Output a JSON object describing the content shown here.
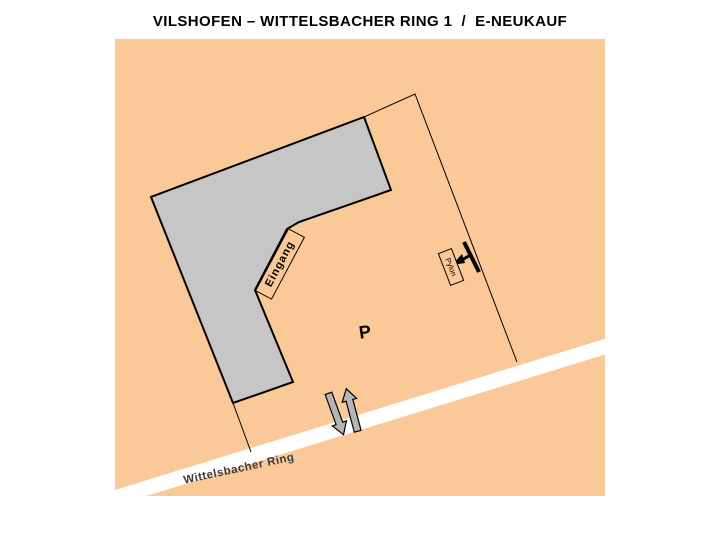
{
  "title": "VILSHOFEN – WITTELSBACHER RING 1  /  E-NEUKAUF",
  "map": {
    "labels": {
      "entrance": "Eingang",
      "parking": "P",
      "pylon": "Pylon",
      "street": "Wittelsbacher Ring"
    },
    "colors": {
      "ground": "#FBC998",
      "building": "#C6C6C6",
      "building_outline": "#000000",
      "boundary_line": "#000000",
      "road": "#FFFFFF",
      "arrow_fill": "#B5B5B5",
      "street_label": "#3C3C3C",
      "marker": "#000000"
    }
  }
}
